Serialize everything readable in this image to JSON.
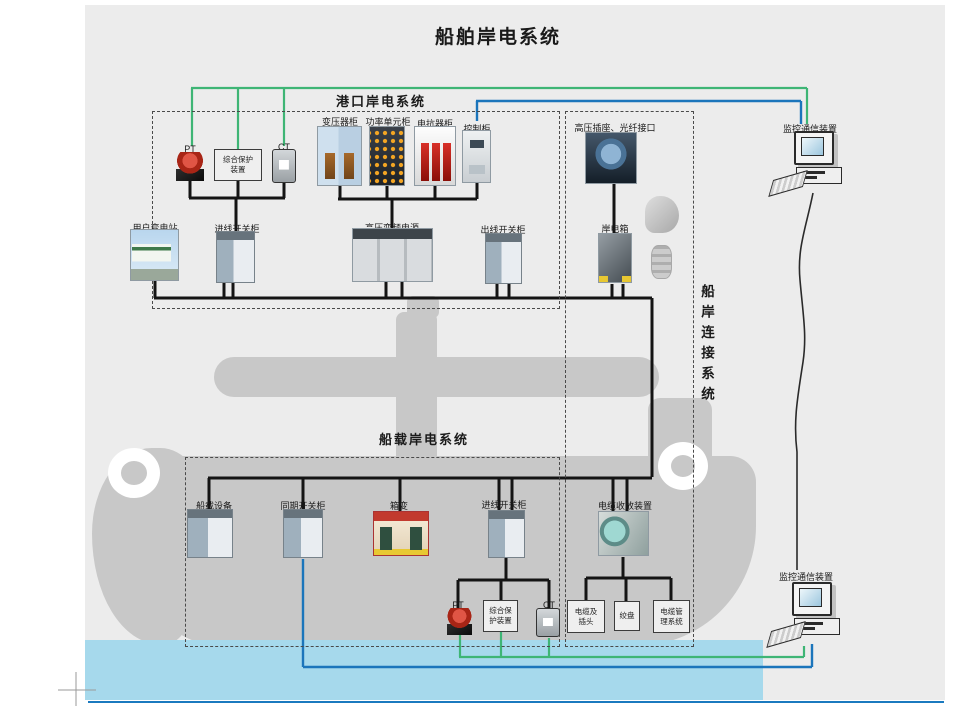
{
  "title": "船舶岸电系统",
  "sections": {
    "port": "港口岸电系统",
    "ship": "船载岸电系统",
    "connection": "船岸连接系统"
  },
  "port_equipment": {
    "pt": "PT",
    "protection": "综合保护装置",
    "ct": "CT",
    "transformer_cabinet": "变压器柜",
    "power_unit_cabinet": "功率单元柜",
    "reactor_cabinet": "电抗器柜",
    "control_cabinet": "控制柜",
    "user_substation": "用户变电站",
    "incoming_switchgear": "进线开关柜",
    "hv_vfd_power": "高压变频电源",
    "outgoing_switchgear": "出线开关柜"
  },
  "connection_equipment": {
    "hv_socket_fiber": "高压插座、光纤接口",
    "shore_power_box": "岸电箱",
    "cable_reel_device": "电缆收放装置",
    "cable_and_plug": "电缆及插头",
    "winch": "绞盘",
    "cable_mgmt_system": "电缆管理系统"
  },
  "ship_equipment": {
    "shipboard_equipment": "船载设备",
    "sync_switchgear": "同期开关柜",
    "box_transformer": "箱变",
    "incoming_switchgear": "进线开关柜",
    "pt": "PT",
    "protection": "综合保护装置",
    "ct": "CT"
  },
  "monitoring": {
    "top_label": "监控通信装置",
    "bottom_label": "监控通信装置"
  },
  "colors": {
    "line_green": "#3eb575",
    "line_blue": "#1b75bb",
    "line_black": "#141414",
    "water": "#a6d9ec",
    "ship_gray": "#c8c8c8",
    "canvas_gray": "#ececec"
  }
}
